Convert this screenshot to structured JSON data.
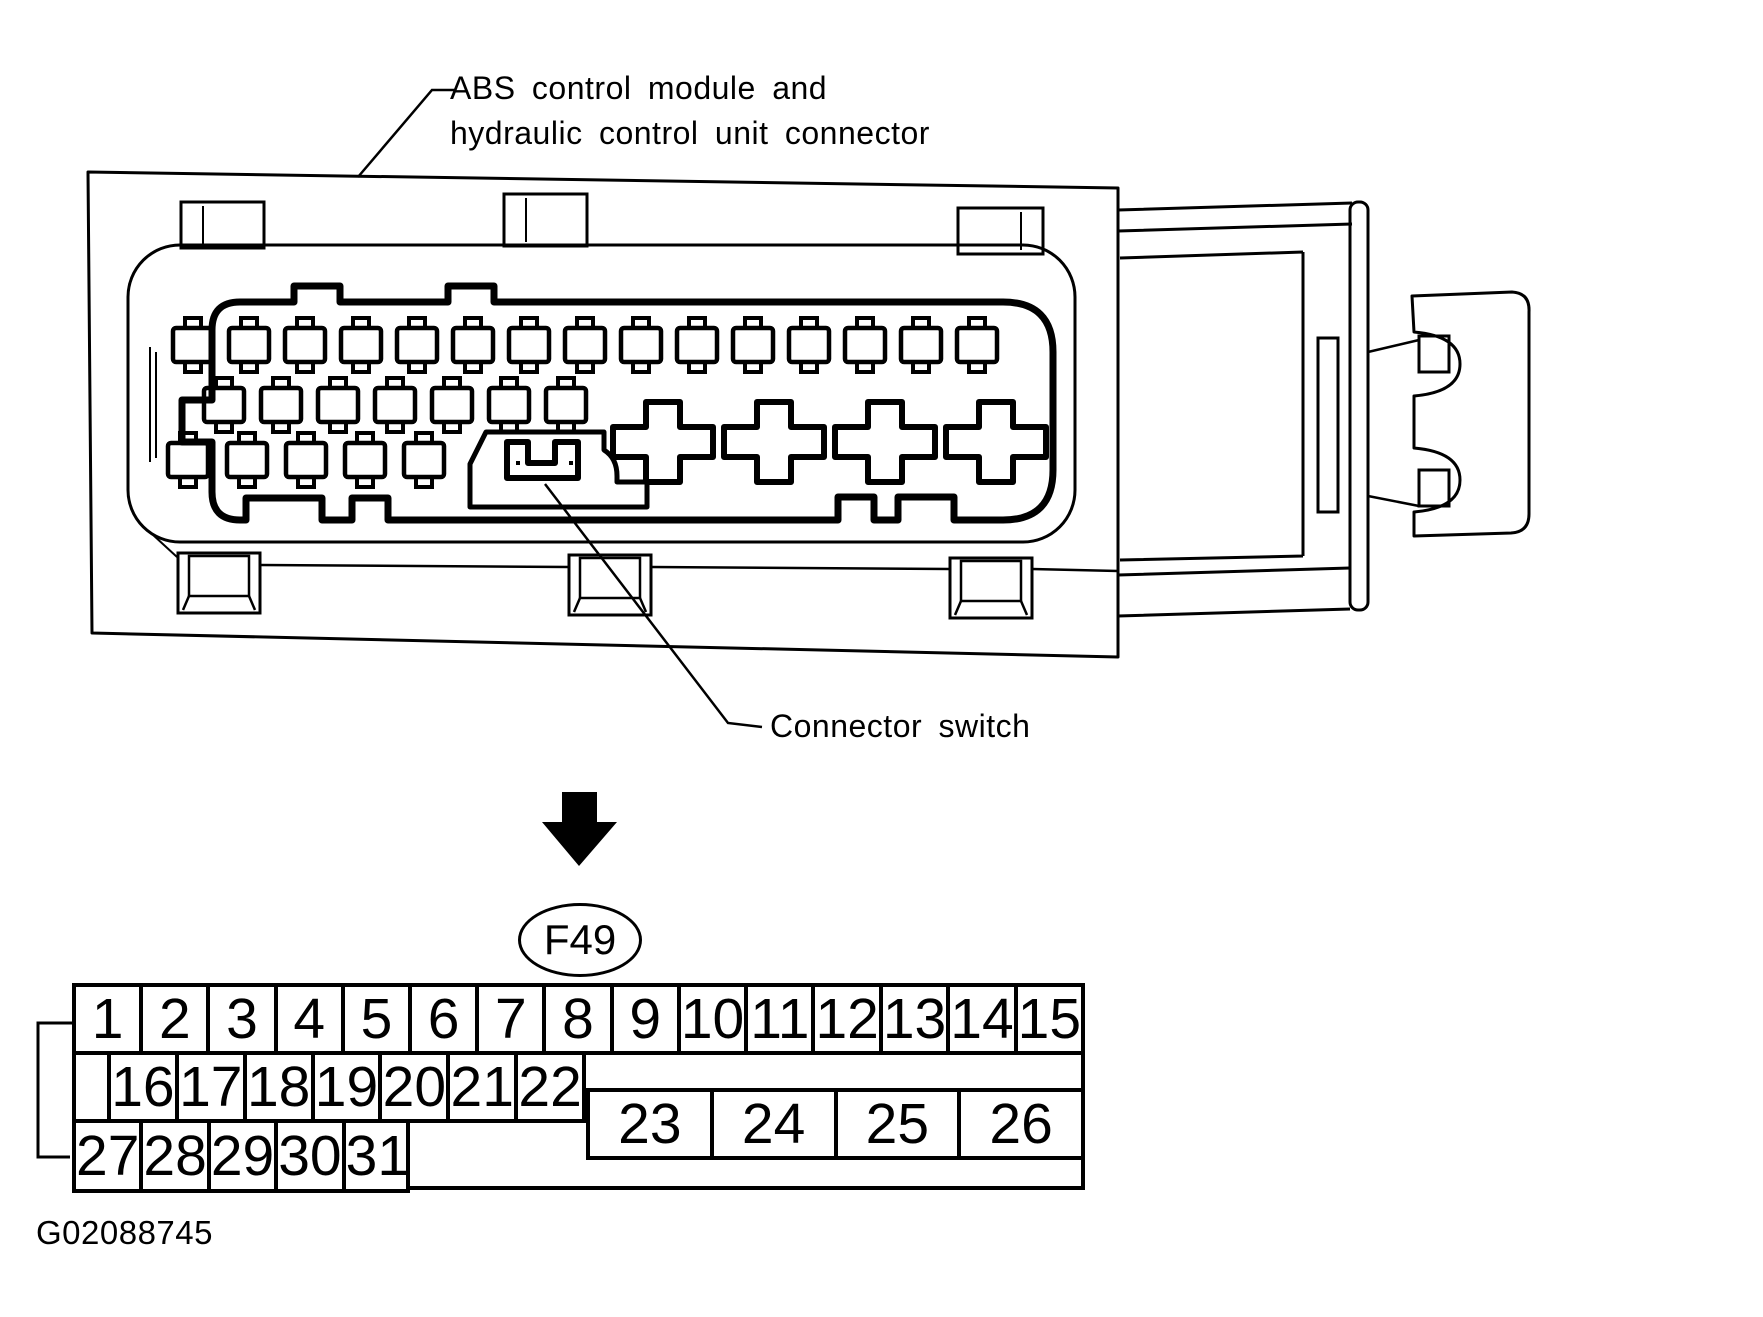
{
  "page": {
    "background": "#ffffff",
    "ink": "#000000"
  },
  "annotations": {
    "module_label": {
      "line1": "ABS control module and",
      "line2": "hydraulic control unit connector"
    },
    "switch_label": "Connector switch",
    "connector_ref": "F49",
    "figure_code": "G02088745"
  },
  "pin_map": {
    "row1": [
      "1",
      "2",
      "3",
      "4",
      "5",
      "6",
      "7",
      "8",
      "9",
      "10",
      "11",
      "12",
      "13",
      "14",
      "15"
    ],
    "row2": [
      "16",
      "17",
      "18",
      "19",
      "20",
      "21",
      "22"
    ],
    "wide_row": [
      "23",
      "24",
      "25",
      "26"
    ],
    "row3": [
      "27",
      "28",
      "29",
      "30",
      "31"
    ]
  },
  "diagram": {
    "small_pins_top_row": 15,
    "small_pins_middle_row": 7,
    "small_pins_bottom_row": 5,
    "cross_pins": 4,
    "total_pins": 31
  }
}
